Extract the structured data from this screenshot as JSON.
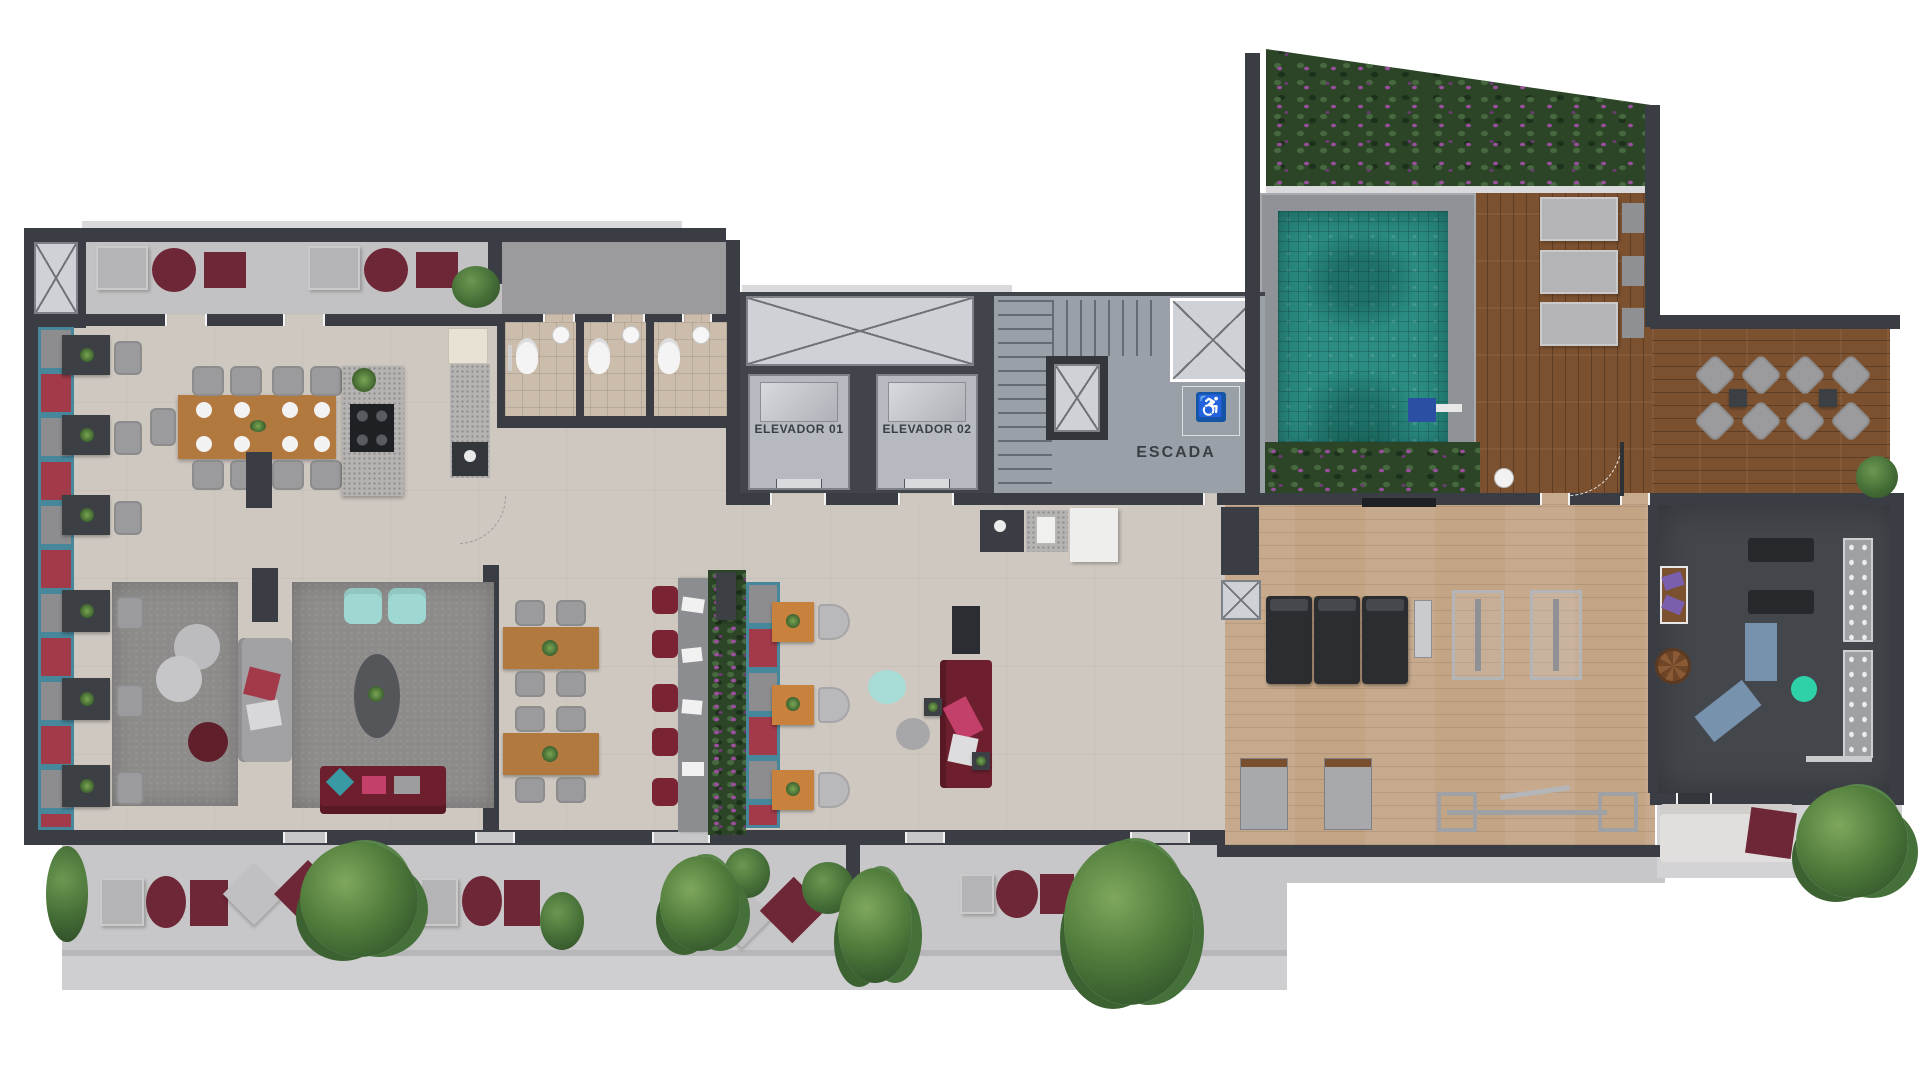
{
  "core": {
    "elevator_1": "ELEVADOR 01",
    "elevator_2": "ELEVADOR 02",
    "stairs_label": "ESCADA",
    "accessibility_icon": "♿"
  },
  "palette": {
    "wall": "#3a3e44",
    "floor": "#cfc8c1",
    "balcony": "#c2c2c4",
    "corridor": "#9b9b9e",
    "carpet": "#8e8c8b",
    "terrace": "#c7c6c8",
    "teal": "#47879b",
    "cushion_gray": "#8d8d8f",
    "cushion_red": "#a23a49",
    "maroon": "#6e2737",
    "wood": "#b2793f",
    "deck": "#7c5130",
    "gym_wood": "#c3a484",
    "dark_floor": "#43474c",
    "pool": "#2a8c82",
    "pool_border": "#8f9296",
    "hedge": "#2c4527",
    "flower": "#9b4f9e",
    "mint": "#a8dcd6",
    "aqua": "#9fd8d2",
    "orange": "#c8823d",
    "chair": "#9b9a9c",
    "access_blue": "#1456a6",
    "label": "#3a3f46",
    "island": "#b5b4b2",
    "tile": "#cbbcab",
    "stair": "#9aa0a8",
    "shaft": "#ced1d6",
    "blue_mat": "#7792ad",
    "ball_teal": "#2fd1a8",
    "red_sofa": "#6e1f2e",
    "pink": "#c2406a",
    "purple_cushion": "#7a5fae",
    "treadmill": "#2b2d30",
    "cream": "#e8e2d4"
  }
}
